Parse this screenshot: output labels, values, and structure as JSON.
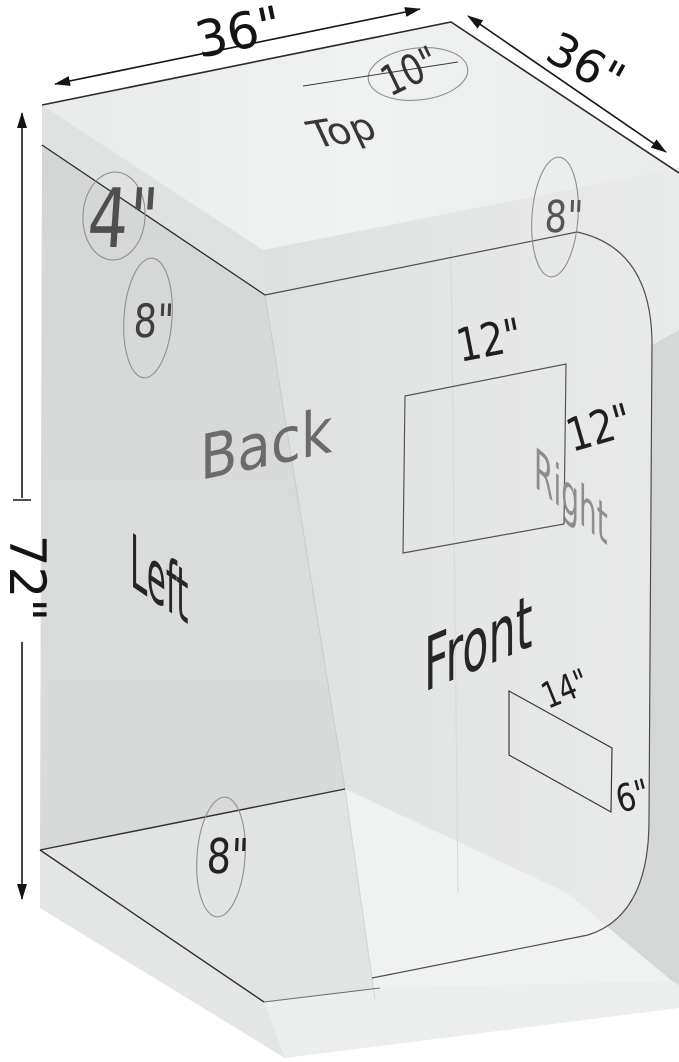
{
  "diagram": {
    "type": "grow-tent-dimension-diagram",
    "faces": {
      "top": "Top",
      "back": "Back",
      "left": "Left",
      "right": "Right",
      "front": "Front"
    },
    "dimensions": {
      "top_width": "36\"",
      "top_depth": "36\"",
      "side_height": "72\""
    },
    "ports": {
      "top_duct": "10\"",
      "top_left_vent": "4\"",
      "left_upper_duct": "8\"",
      "right_upper_duct": "8\"",
      "rear_lower_duct": "8\"",
      "side_window_width": "12\"",
      "side_window_height": "12\"",
      "front_vent_width": "14\"",
      "front_vent_height": "6\""
    },
    "colors": {
      "background": "#ffffff",
      "top_face": "#eff1f1",
      "left_wall": "#d6d8d8",
      "right_wall": "#e6e7e7",
      "floor": "#f0f1f1",
      "dark_corner": "#d2d4d4",
      "edge_line": "#2b2b2b"
    }
  }
}
